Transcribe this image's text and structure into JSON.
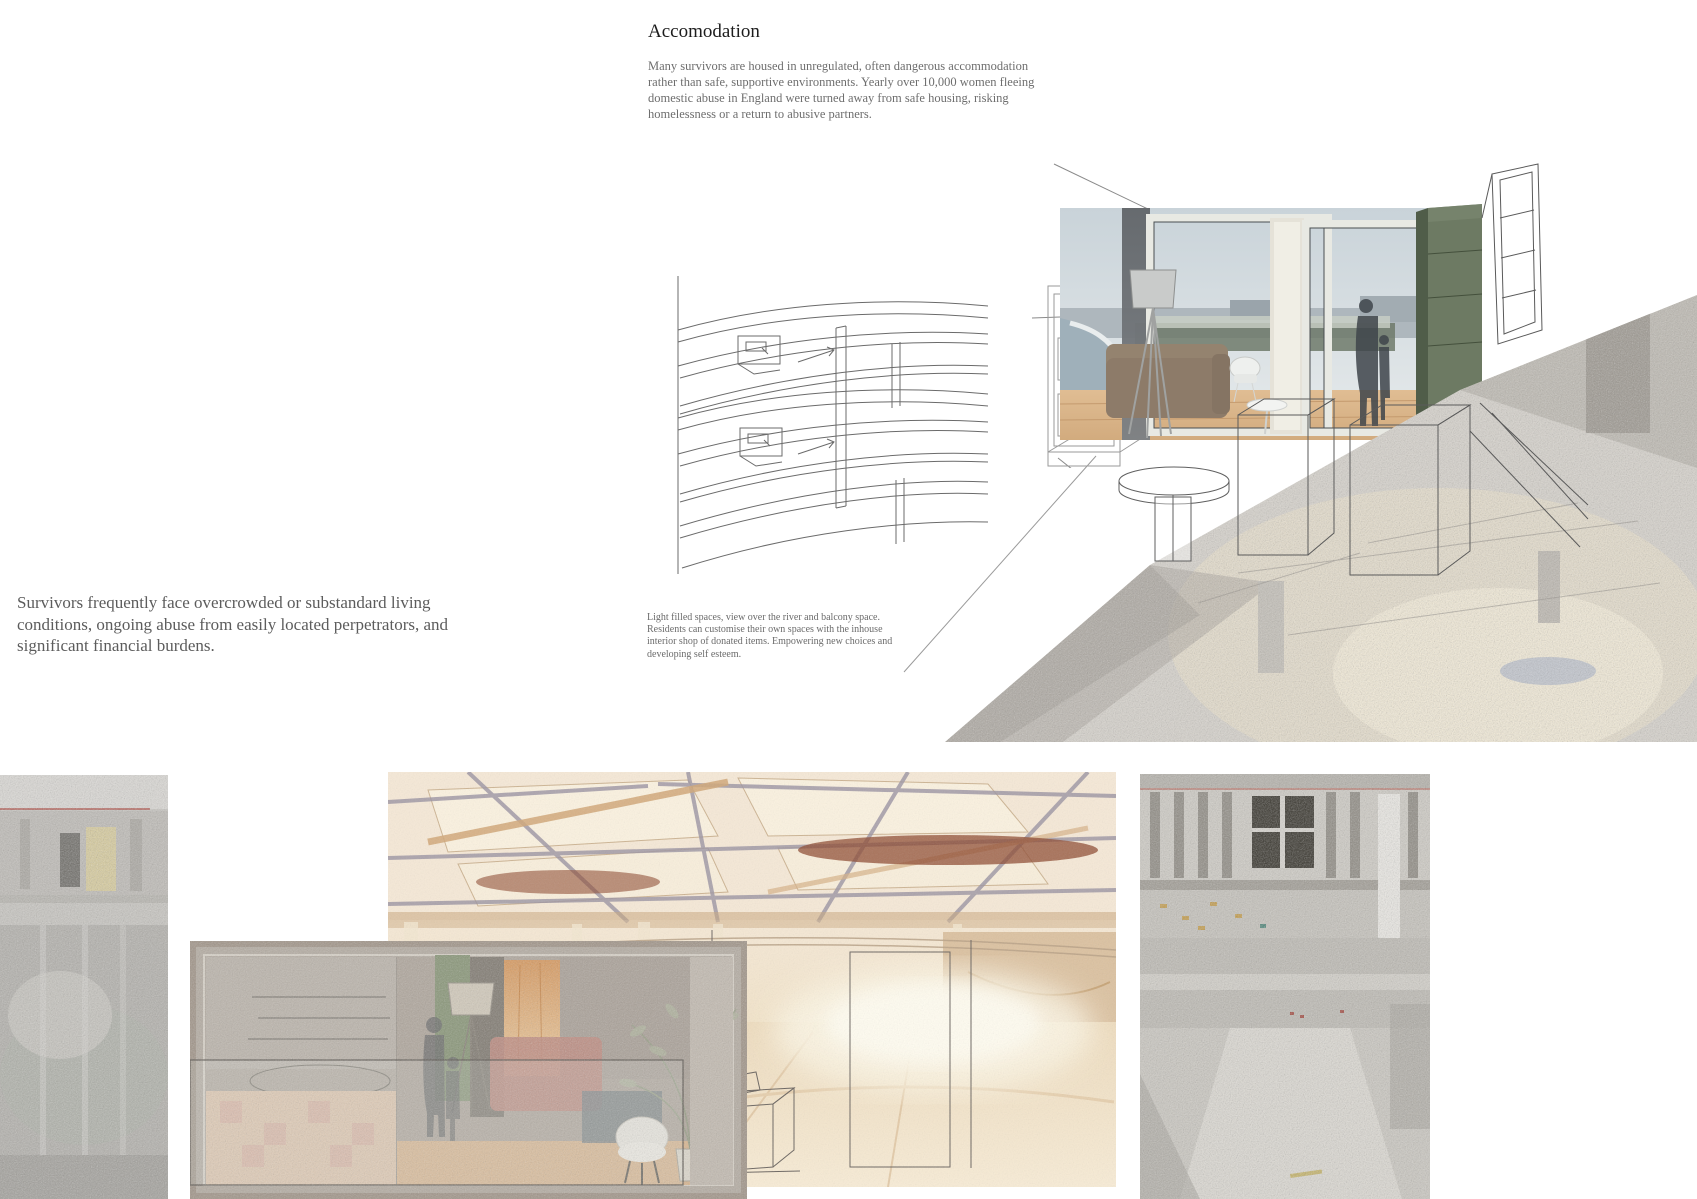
{
  "header": {
    "title": "Accomodation",
    "intro": "Many survivors are housed in unregulated, often dangerous accommodation rather than safe, supportive environments. Yearly over 10,000 women fleeing domestic abuse in England were turned away from safe housing, risking homelessness or a return to abusive partners."
  },
  "statement": {
    "text": "Survivors frequently face overcrowded or substandard living conditions, ongoing abuse from easily located perpetrators, and significant financial burdens."
  },
  "caption": {
    "text": "Light filled spaces, view over the river and balcony space.  Residents can customise their own spaces with the inhouse interior shop of donated items. Empowering new choices and developing self esteem."
  },
  "annotations": {
    "dimension_label": "1890"
  },
  "colors": {
    "background": "#ffffff",
    "title_text": "#1d1d1d",
    "body_text": "#6e6e6e",
    "statement_text": "#5c5c5c",
    "line_art": "#5a5a5a",
    "pointcloud_gray": "#d6d2cb",
    "warm_render_beige": "#f3e3cb",
    "wardrobe_green": "#6d7a63",
    "accent_wood": "#d9b488",
    "accent_red_beam": "#8e4a30"
  }
}
